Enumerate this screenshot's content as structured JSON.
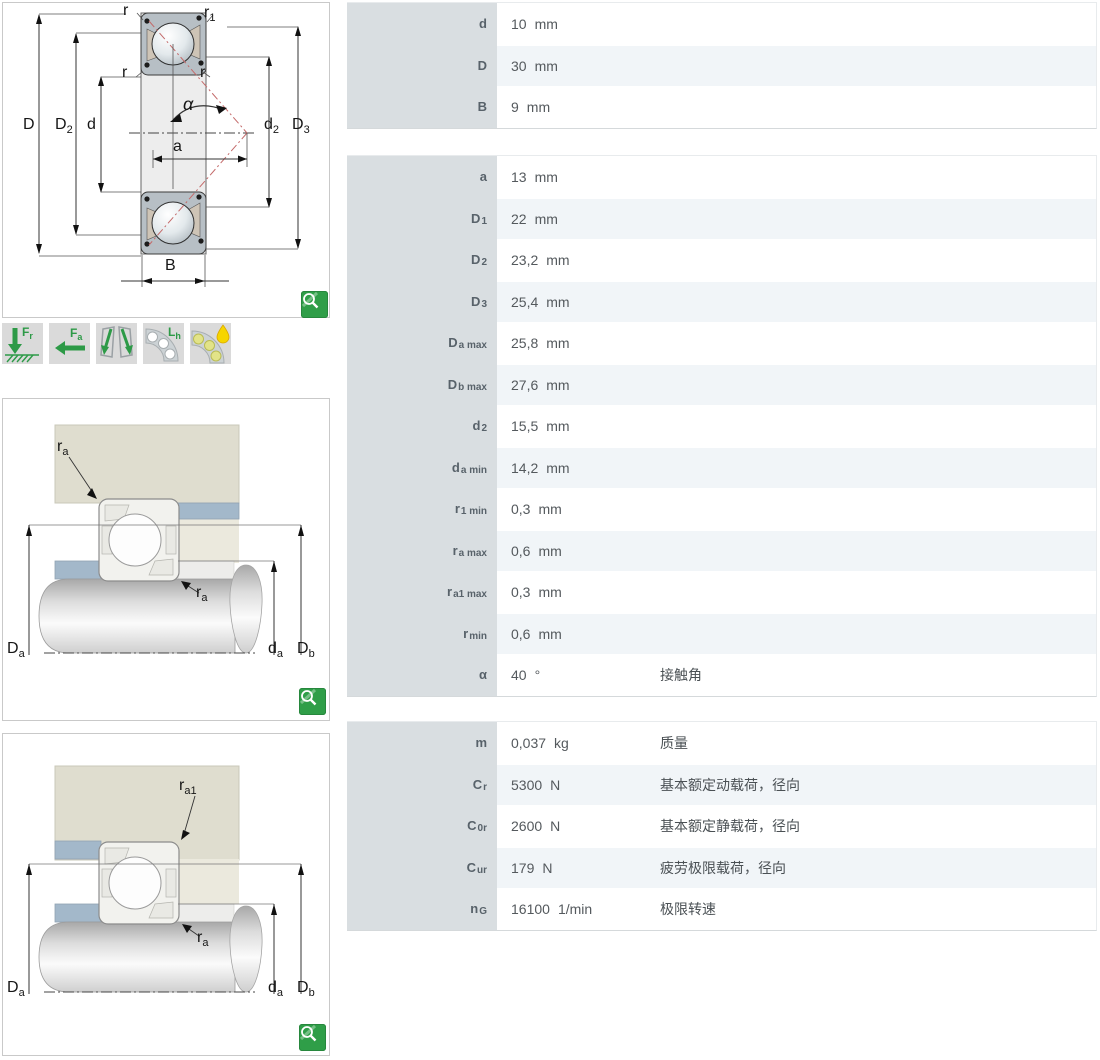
{
  "colors": {
    "accent_green": "#2f9e48",
    "icon_green": "#2d9a47",
    "label_column_bg": "#d9dee1",
    "row_tint": "#f1f5f8",
    "housing_beige": "#dfddcf",
    "spacer_blue": "#a3b8ca",
    "contact_line_red": "#c46a6a"
  },
  "zoom_button": {
    "icon": "magnifier-icon"
  },
  "feature_icons": [
    {
      "name": "radial-load-icon",
      "label": "F",
      "sub": "r"
    },
    {
      "name": "axial-load-icon",
      "label": "F",
      "sub": "a"
    },
    {
      "name": "misalignment-icon",
      "label": "",
      "sub": ""
    },
    {
      "name": "rating-life-icon",
      "label": "L",
      "sub": "h"
    },
    {
      "name": "lubrication-icon",
      "label": "",
      "sub": ""
    }
  ],
  "diagram_labels": {
    "section": {
      "r_top": {
        "main": "r",
        "sub": ""
      },
      "r1": {
        "main": "r",
        "sub": "1"
      },
      "r_mid_left": {
        "main": "r",
        "sub": ""
      },
      "r_mid_right": {
        "main": "r",
        "sub": ""
      },
      "alpha": {
        "main": "α",
        "sub": ""
      },
      "a": {
        "main": "a",
        "sub": ""
      },
      "d": {
        "main": "d",
        "sub": ""
      },
      "D": {
        "main": "D",
        "sub": ""
      },
      "D2": {
        "main": "D",
        "sub": "2"
      },
      "d2": {
        "main": "d",
        "sub": "2"
      },
      "D3": {
        "main": "D",
        "sub": "3"
      },
      "B": {
        "main": "B",
        "sub": ""
      }
    },
    "fit1": {
      "ra_housing": {
        "main": "r",
        "sub": "a"
      },
      "ra_shaft": {
        "main": "r",
        "sub": "a"
      },
      "Da": {
        "main": "D",
        "sub": "a"
      },
      "da": {
        "main": "d",
        "sub": "a"
      },
      "Db": {
        "main": "D",
        "sub": "b"
      }
    },
    "fit2": {
      "ra1": {
        "main": "r",
        "sub": "a1"
      },
      "ra_shaft": {
        "main": "r",
        "sub": "a"
      },
      "Da": {
        "main": "D",
        "sub": "a"
      },
      "da": {
        "main": "d",
        "sub": "a"
      },
      "Db": {
        "main": "D",
        "sub": "b"
      }
    }
  },
  "tables": [
    {
      "rows": [
        {
          "key": "d",
          "label": "d",
          "sub": "",
          "value": "10",
          "unit": "mm",
          "desc": ""
        },
        {
          "key": "D",
          "label": "D",
          "sub": "",
          "value": "30",
          "unit": "mm",
          "desc": ""
        },
        {
          "key": "B",
          "label": "B",
          "sub": "",
          "value": "9",
          "unit": "mm",
          "desc": ""
        }
      ]
    },
    {
      "rows": [
        {
          "key": "a",
          "label": "a",
          "sub": "",
          "value": "13",
          "unit": "mm",
          "desc": ""
        },
        {
          "key": "D1",
          "label": "D",
          "sub": "1",
          "value": "22",
          "unit": "mm",
          "desc": ""
        },
        {
          "key": "D2",
          "label": "D",
          "sub": "2",
          "value": "23,2",
          "unit": "mm",
          "desc": ""
        },
        {
          "key": "D3",
          "label": "D",
          "sub": "3",
          "value": "25,4",
          "unit": "mm",
          "desc": ""
        },
        {
          "key": "Da-max",
          "label": "D",
          "sub": "a max",
          "value": "25,8",
          "unit": "mm",
          "desc": ""
        },
        {
          "key": "Db-max",
          "label": "D",
          "sub": "b max",
          "value": "27,6",
          "unit": "mm",
          "desc": ""
        },
        {
          "key": "d2",
          "label": "d",
          "sub": "2",
          "value": "15,5",
          "unit": "mm",
          "desc": ""
        },
        {
          "key": "da-min",
          "label": "d",
          "sub": "a min",
          "value": "14,2",
          "unit": "mm",
          "desc": ""
        },
        {
          "key": "r1-min",
          "label": "r",
          "sub": "1 min",
          "value": "0,3",
          "unit": "mm",
          "desc": ""
        },
        {
          "key": "ra-max",
          "label": "r",
          "sub": "a max",
          "value": "0,6",
          "unit": "mm",
          "desc": ""
        },
        {
          "key": "ra1-max",
          "label": "r",
          "sub": "a1 max",
          "value": "0,3",
          "unit": "mm",
          "desc": ""
        },
        {
          "key": "r-min",
          "label": "r",
          "sub": "min",
          "value": "0,6",
          "unit": "mm",
          "desc": ""
        },
        {
          "key": "alpha",
          "label": "α",
          "sub": "",
          "value": "40",
          "unit": "°",
          "desc": "接触角"
        }
      ]
    },
    {
      "rows": [
        {
          "key": "m",
          "label": "m",
          "sub": "",
          "value": "0,037",
          "unit": "kg",
          "desc": "质量"
        },
        {
          "key": "Cr",
          "label": "C",
          "sub": "r",
          "value": "5300",
          "unit": "N",
          "desc": "基本额定动载荷，径向"
        },
        {
          "key": "C0r",
          "label": "C",
          "sub": "0r",
          "value": "2600",
          "unit": "N",
          "desc": "基本额定静载荷，径向"
        },
        {
          "key": "Cur",
          "label": "C",
          "sub": "ur",
          "value": "179",
          "unit": "N",
          "desc": "疲劳极限载荷，径向"
        },
        {
          "key": "nG",
          "label": "n",
          "sub": "G",
          "value": "16100",
          "unit": "1/min",
          "desc": "极限转速"
        }
      ]
    }
  ]
}
